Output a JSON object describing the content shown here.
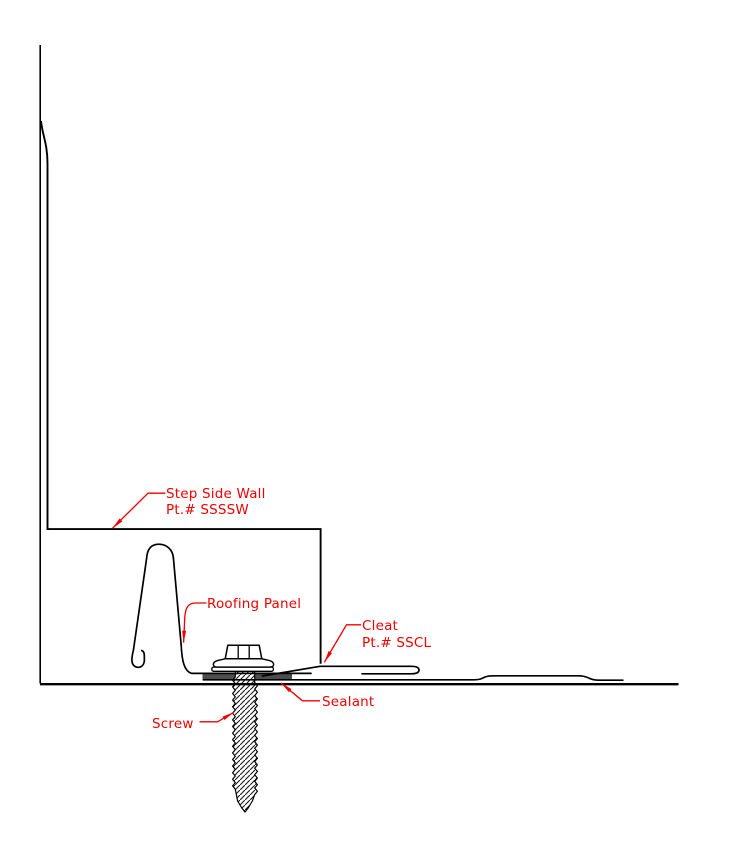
{
  "labels": {
    "step_side_wall": {
      "name": "Step Side Wall",
      "part": "Pt.# SSSSW"
    },
    "roofing_panel": {
      "name": "Roofing Panel"
    },
    "cleat": {
      "name": "Cleat",
      "part": "Pt.# SSCL"
    },
    "sealant": {
      "name": "Sealant"
    },
    "screw": {
      "name": "Screw"
    }
  },
  "colors": {
    "annotation_red": "#f10000",
    "line_black": "#000000",
    "sealant_gray": "#4d4d4d",
    "background": "#ffffff"
  }
}
